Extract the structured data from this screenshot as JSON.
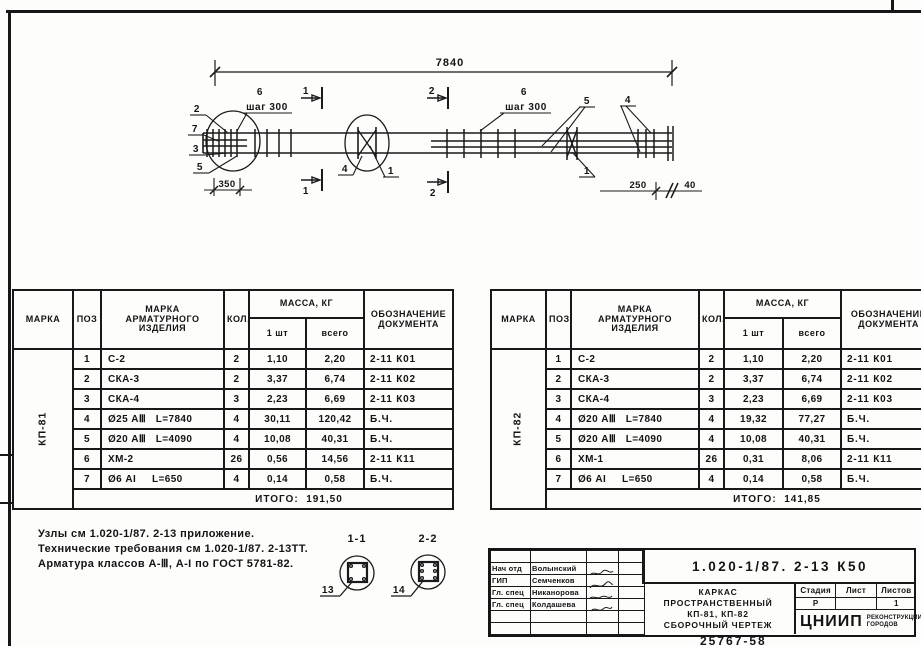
{
  "drawing": {
    "dims": {
      "total": "7840",
      "left": "350",
      "right_a": "250",
      "right_b": "40"
    },
    "labels": {
      "step_left_num": "6",
      "step_left": "шаг 300",
      "step_right_num": "6",
      "step_right": "шаг 300"
    },
    "callouts": {
      "left_2": "2",
      "left_7": "7",
      "left_3": "3",
      "left_5": "5",
      "mid_4": "4",
      "mid_1": "1",
      "right_5": "5",
      "right_4": "4",
      "right_1": "1"
    },
    "sections": {
      "mark1": "1",
      "mark2": "2"
    }
  },
  "details": {
    "s11": {
      "label": "1-1",
      "callout": "13"
    },
    "s22": {
      "label": "2-2",
      "callout": "14"
    }
  },
  "notes": [
    "Узлы см 1.020-1/87. 2-13 приложение.",
    "Технические требования см 1.020-1/87. 2-13ТТ.",
    "Арматура классов А-Ⅲ, А-I по ГОСТ 5781-82."
  ],
  "table_headers": {
    "mark": "МАРКА",
    "pos": "ПОЗ",
    "item": "МАРКА\nАРМАТУРНОГО\nИЗДЕЛИЯ",
    "qty": "КОЛ.",
    "mass": "МАССА, КГ",
    "one": "1 шт",
    "all": "всего",
    "doc": "ОБОЗНАЧЕНИЕ\nДОКУМЕНТА"
  },
  "left_table": {
    "mark": "КП-81",
    "rows": [
      {
        "pos": "1",
        "item": "С-2",
        "qty": "2",
        "one": "1,10",
        "all": "2,20",
        "doc": "2-11 К01"
      },
      {
        "pos": "2",
        "item": "СКА-3",
        "qty": "2",
        "one": "3,37",
        "all": "6,74",
        "doc": "2-11 К02"
      },
      {
        "pos": "3",
        "item": "СКА-4",
        "qty": "3",
        "one": "2,23",
        "all": "6,69",
        "doc": "2-11 К03"
      },
      {
        "pos": "4",
        "item": "Ø25 АⅢ   L=7840",
        "qty": "4",
        "one": "30,11",
        "all": "120,42",
        "doc": "Б.Ч."
      },
      {
        "pos": "5",
        "item": "Ø20 АⅢ   L=4090",
        "qty": "4",
        "one": "10,08",
        "all": "40,31",
        "doc": "Б.Ч."
      },
      {
        "pos": "6",
        "item": "ХМ-2",
        "qty": "26",
        "one": "0,56",
        "all": "14,56",
        "doc": "2-11 К11"
      },
      {
        "pos": "7",
        "item": "Ø6 АI     L=650",
        "qty": "4",
        "one": "0,14",
        "all": "0,58",
        "doc": "Б.Ч."
      }
    ],
    "total_label": "ИТОГО:",
    "total": "191,50"
  },
  "right_table": {
    "mark": "КП-82",
    "rows": [
      {
        "pos": "1",
        "item": "С-2",
        "qty": "2",
        "one": "1,10",
        "all": "2,20",
        "doc": "2-11 К01"
      },
      {
        "pos": "2",
        "item": "СКА-3",
        "qty": "2",
        "one": "3,37",
        "all": "6,74",
        "doc": "2-11 К02"
      },
      {
        "pos": "3",
        "item": "СКА-4",
        "qty": "3",
        "one": "2,23",
        "all": "6,69",
        "doc": "2-11 К03"
      },
      {
        "pos": "4",
        "item": "Ø20 АⅢ   L=7840",
        "qty": "4",
        "one": "19,32",
        "all": "77,27",
        "doc": "Б.Ч."
      },
      {
        "pos": "5",
        "item": "Ø20 АⅢ   L=4090",
        "qty": "4",
        "one": "10,08",
        "all": "40,31",
        "doc": "Б.Ч."
      },
      {
        "pos": "6",
        "item": "ХМ-1",
        "qty": "26",
        "one": "0,31",
        "all": "8,06",
        "doc": "2-11 К11"
      },
      {
        "pos": "7",
        "item": "Ø6 АI     L=650",
        "qty": "4",
        "one": "0,14",
        "all": "0,58",
        "doc": "Б.Ч."
      }
    ],
    "total_label": "ИТОГО:",
    "total": "141,85"
  },
  "title_block": {
    "doc_number": "1.020-1/87. 2-13 К50",
    "title": "КАРКАС\nПРОСТРАНСТВЕННЫЙ\nКП-81, КП-82\nСБОРОЧНЫЙ ЧЕРТЕЖ",
    "stage_label": "Стадия",
    "sheet_label": "Лист",
    "sheets_label": "Листов",
    "stage": "Р",
    "sheet": "",
    "sheets": "1",
    "org": "ЦНИИП",
    "org_sub": "РЕКОНСТРУКЦИИ\nГОРОДОВ",
    "signers": [
      {
        "role": "Нач отд",
        "name": "Волынский"
      },
      {
        "role": "ГИП",
        "name": "Семченков"
      },
      {
        "role": "Гл. спец",
        "name": "Никанорова"
      },
      {
        "role": "Гл. спец",
        "name": "Колдашева"
      }
    ]
  },
  "sheet": {
    "bottom_number": "25767-58"
  }
}
